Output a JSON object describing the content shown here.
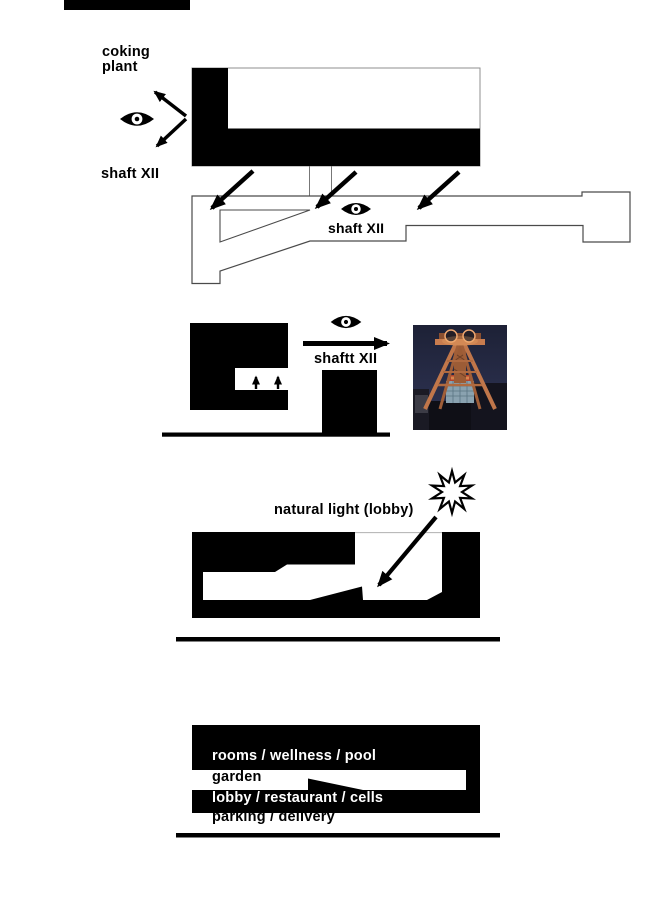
{
  "page": {
    "background": "#ffffff",
    "width": 672,
    "height": 900
  },
  "palette": {
    "ink": "#000000",
    "outline_gray": "#4a4a4a",
    "thin_gray": "#8f8f8f",
    "photo_sky": "#222741",
    "photo_frame_orange": "#c0764a",
    "photo_building_blue": "#8aa2b0"
  },
  "section_shaft_plan": {
    "coking_plant_label": "coking\nplant",
    "shaft_label": "shaft XII"
  },
  "section_site_plan": {
    "shaft_label": "shaft XII"
  },
  "section_elevation": {
    "shaft_label": "shaftt XII"
  },
  "section_light": {
    "label": "natural light (lobby)"
  },
  "section_program": {
    "rows": [
      {
        "label": "rooms / wellness / pool"
      },
      {
        "label": "garden"
      },
      {
        "label": "lobby / restaurant / cells"
      },
      {
        "label": "parking / delivery"
      }
    ]
  }
}
